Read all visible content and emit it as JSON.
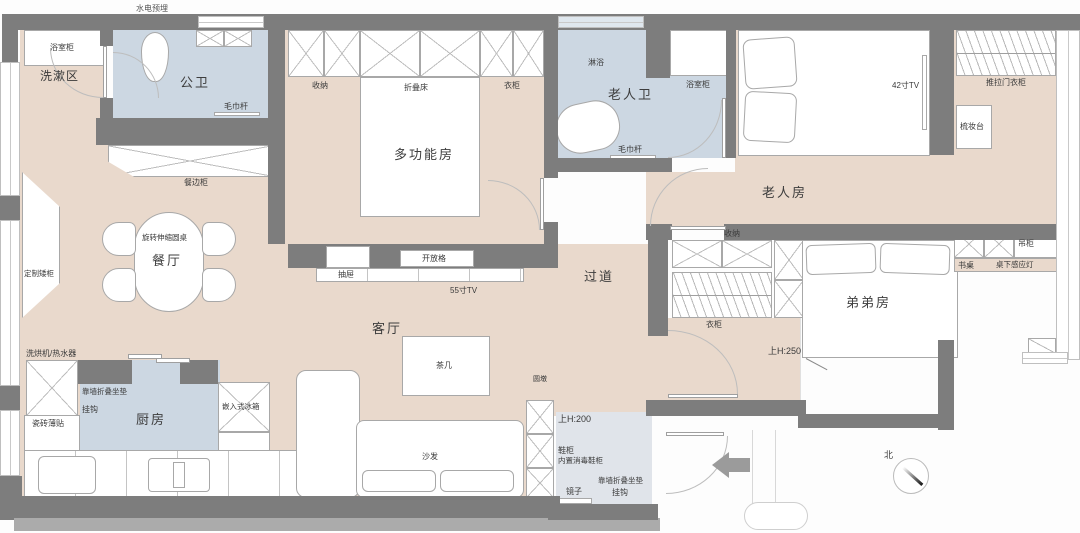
{
  "title": "三室两卫户型平面图",
  "colors": {
    "wall": "#7d7d7d",
    "wallshadow": "#ababab",
    "tan": "#e9d9cc",
    "wet": "#ccd7e2",
    "entry": "#e0e4ea",
    "line": "#a8a8a8",
    "ink": "#3a3a3a",
    "windowblue": "#dfe7ee",
    "arrow": "#9b9b9b"
  },
  "labels": {
    "top_note": "水电预埋",
    "wash_area": "洗漱区",
    "bath_cabinet": "浴室柜",
    "public_bath": "公卫",
    "towel_bar": "毛巾杆",
    "storage": "收纳",
    "folding_bed": "折叠床",
    "wardrobe": "衣柜",
    "multi_room": "多功能房",
    "shower": "淋浴",
    "elder_bath": "老人卫",
    "tv42": "42寸TV",
    "sliding_wardrobe": "推拉门衣柜",
    "dresser": "梳妆台",
    "elder_room": "老人房",
    "sideboard": "餐边柜",
    "round_table": "旋转伸缩圆桌",
    "dining": "餐厅",
    "custom_low_cabinet": "定制矮柜",
    "open_shelf": "开放格",
    "drawer": "抽屉",
    "tv55": "55寸TV",
    "hallway": "过道",
    "up_h250": "上H:250",
    "hang_cabinet": "吊柜",
    "desk": "书桌",
    "desk_lamp": "桌下感应灯",
    "brother_room": "弟弟房",
    "washer_heater": "洗烘机/热水器",
    "wall_cushion": "靠墙折叠坐垫",
    "hook": "挂钩",
    "thin_tile": "瓷砖薄贴",
    "kitchen": "厨房",
    "fridge": "嵌入式冰箱",
    "living": "客厅",
    "tea_table": "茶几",
    "sofa": "沙发",
    "round_stool": "圆墩",
    "up_h200": "上H:200",
    "shoe_cabinet": "鞋柜",
    "shoe_sanitizer": "内置消毒鞋柜",
    "mirror": "镜子",
    "north": "北"
  }
}
